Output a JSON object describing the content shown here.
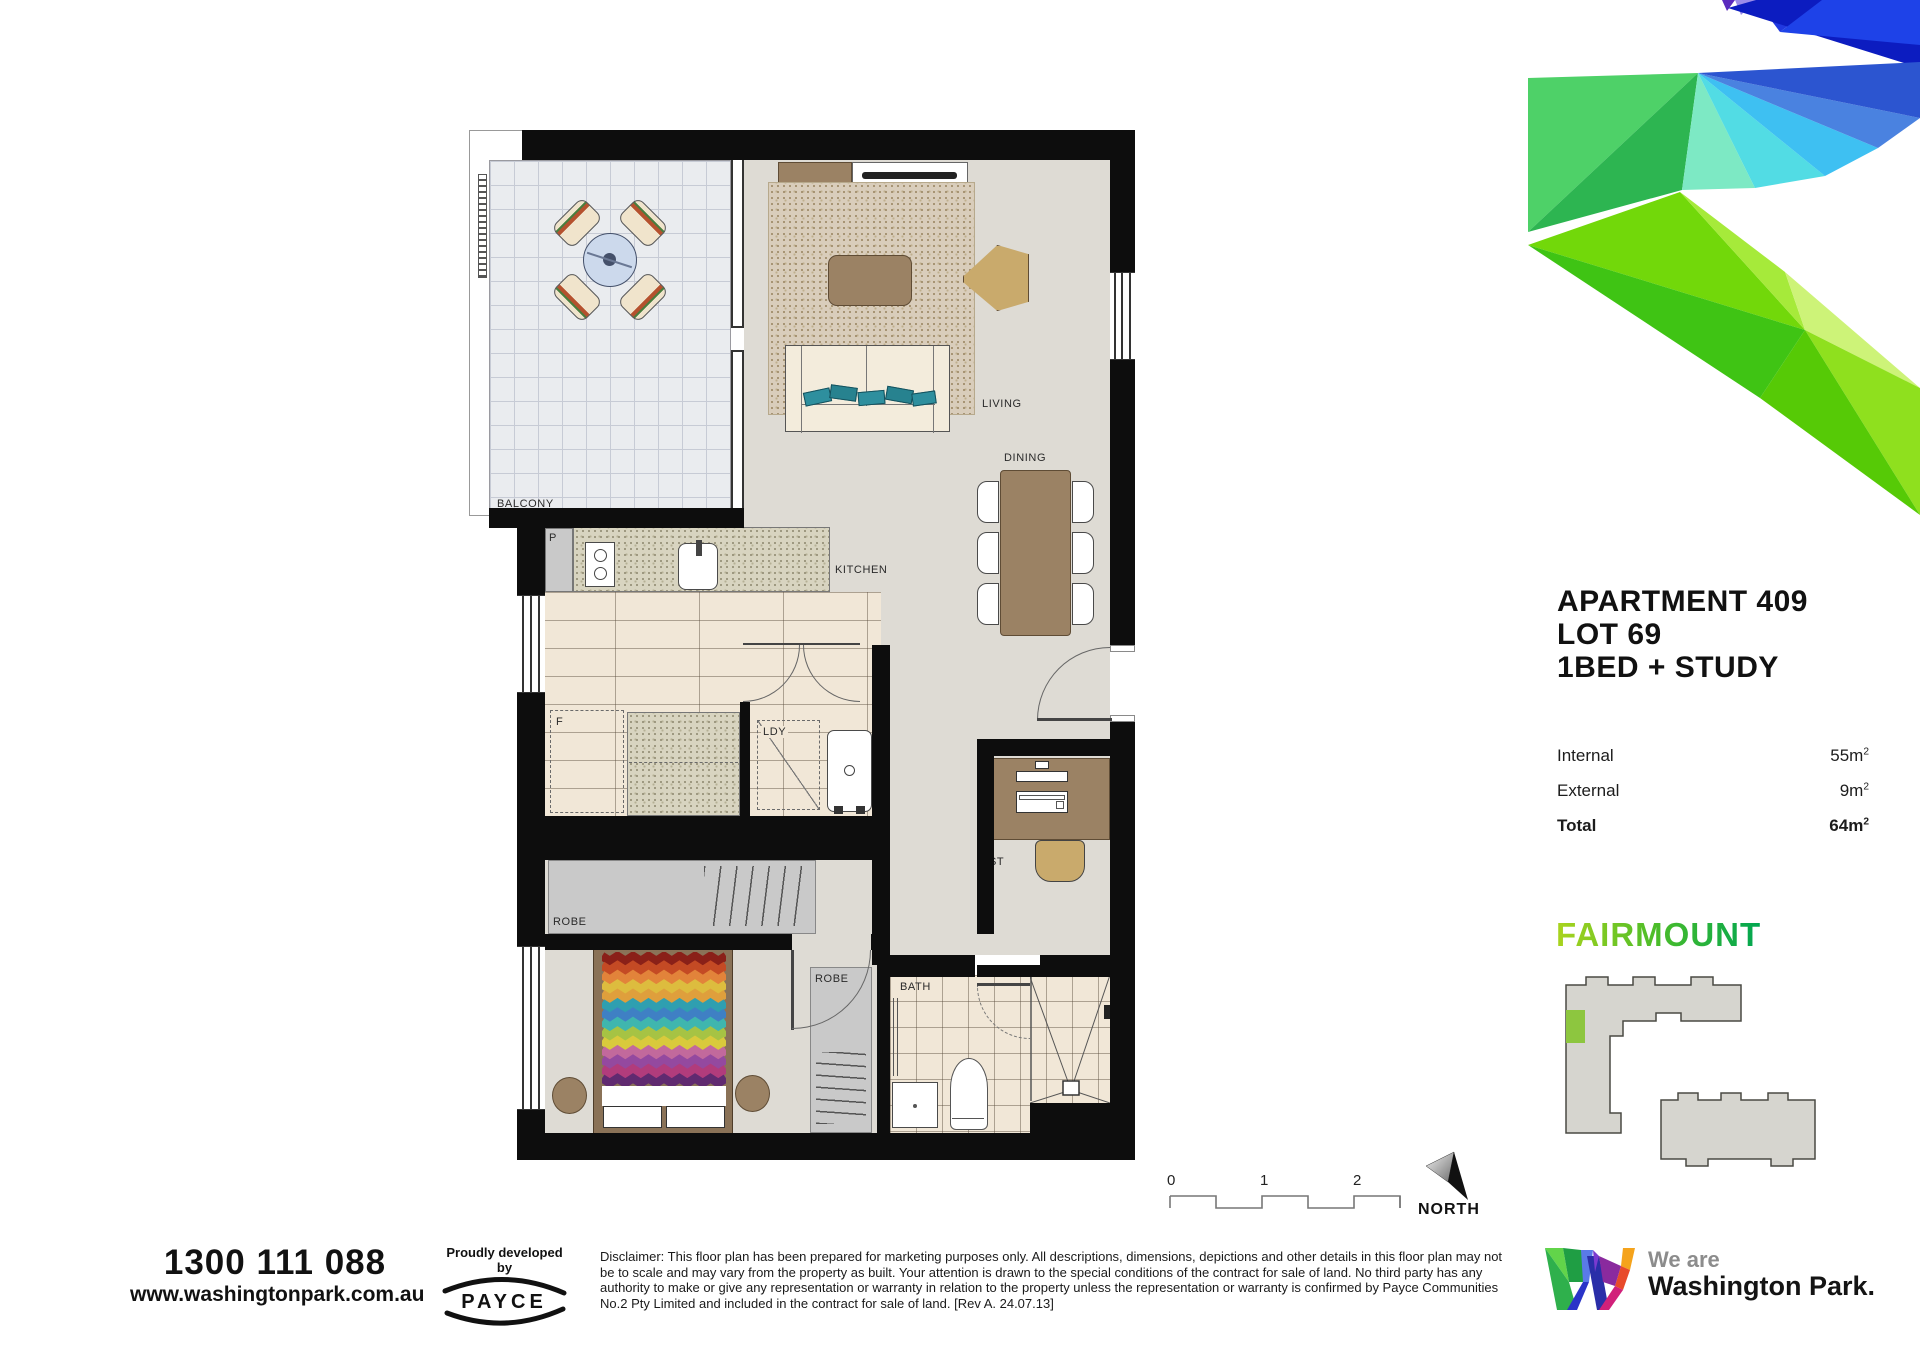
{
  "plan": {
    "rooms": {
      "balcony": "BALCONY",
      "living": "LIVING",
      "dining": "DINING",
      "kitchen": "KITCHEN",
      "pantry": "P",
      "fridge": "F",
      "laundry": "LDY",
      "study": "ST",
      "robe_hall": "ROBE",
      "robe_bed": "ROBE",
      "bath": "BATH"
    }
  },
  "title_block": {
    "line1": "APARTMENT 409",
    "line2": "LOT 69",
    "line3": "1BED + STUDY",
    "areas": [
      {
        "label": "Internal",
        "value": "55m",
        "sup": "2"
      },
      {
        "label": "External",
        "value": "9m",
        "sup": "2"
      },
      {
        "label": "Total",
        "value": "64m",
        "sup": "2"
      }
    ]
  },
  "building": {
    "name": "FAIRMOUNT"
  },
  "scale_bar": {
    "labels": [
      "0",
      "1",
      "2"
    ]
  },
  "compass": {
    "label": "NORTH"
  },
  "contact": {
    "phone": "1300 111 088",
    "website": "www.washingtonpark.com.au"
  },
  "developer": {
    "tagline": "Proudly developed by",
    "name": "PAYCE"
  },
  "disclaimer": {
    "text": "Disclaimer: This floor plan has been prepared for marketing purposes only. All descriptions, dimensions, depictions and other details in this floor plan may not be to scale and may vary from the property as built. Your attention is drawn to the special conditions of the contract for sale of land. No third party has any authority to make or give any representation or warranty in relation to the property unless the representation or warranty is confirmed by Payce Communities No.2 Pty Limited and included in the contract for sale of land.   [Rev A. 24.07.13]"
  },
  "footer_brand": {
    "prefix": "We are",
    "name": "Washington Park."
  },
  "colors": {
    "unit_highlight": "#8dc63f",
    "fairmount_start": "#aad41e",
    "fairmount_end": "#00a651",
    "wall": "#0d0d0d",
    "floor": "#dedbd4"
  }
}
